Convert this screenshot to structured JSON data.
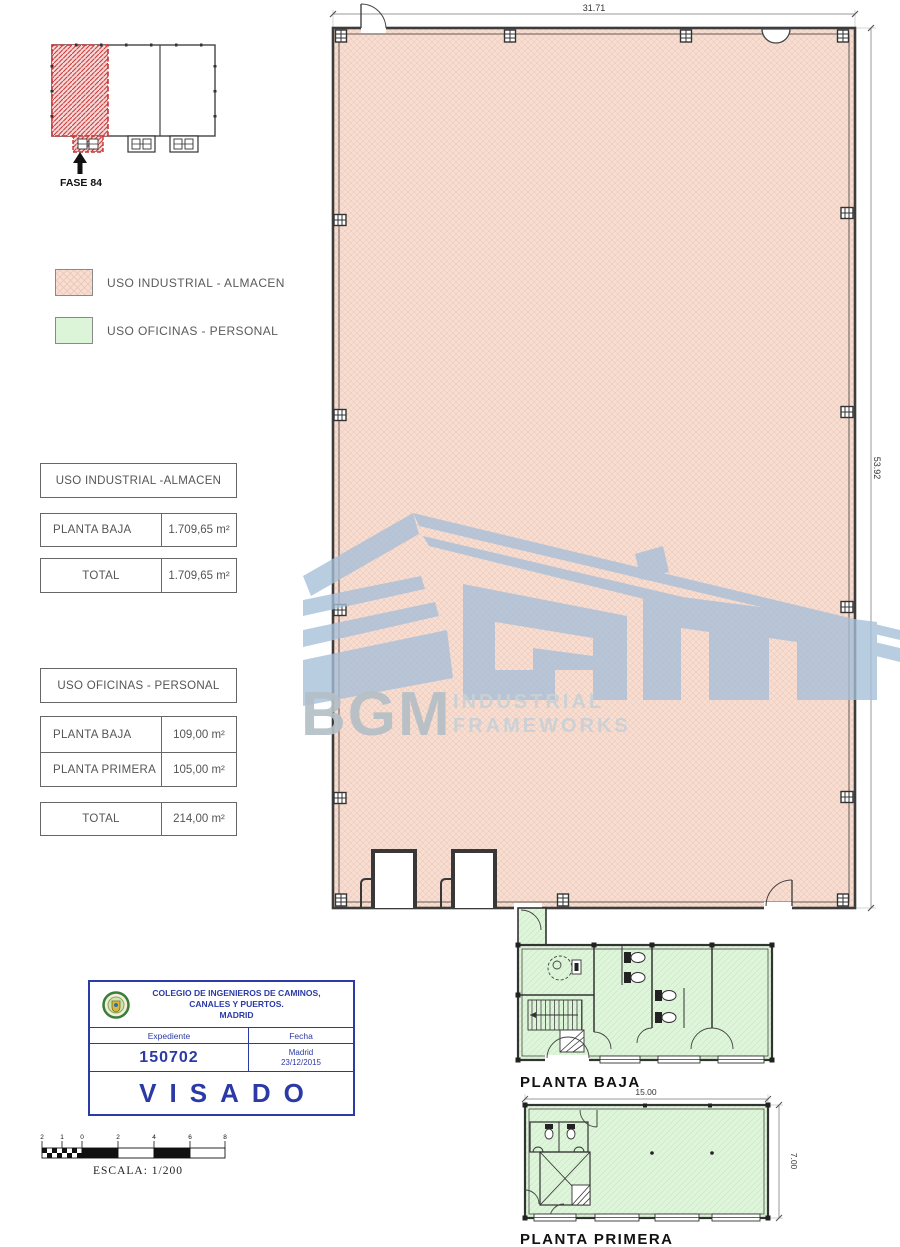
{
  "site": {
    "label": "FASE 84"
  },
  "legend": [
    {
      "label": "USO INDUSTRIAL - ALMACEN"
    },
    {
      "label": "USO OFICINAS - PERSONAL"
    }
  ],
  "tables": {
    "industrial": {
      "title": "USO INDUSTRIAL -ALMACEN",
      "row1_label": "PLANTA BAJA",
      "row1_value": "1.709,65 m²",
      "total_label": "TOTAL",
      "total_value": "1.709,65 m²"
    },
    "oficinas": {
      "title": "USO OFICINAS - PERSONAL",
      "row1_label": "PLANTA BAJA",
      "row1_value": "109,00 m²",
      "row2_label": "PLANTA PRIMERA",
      "row2_value": "105,00 m²",
      "total_label": "TOTAL",
      "total_value": "214,00 m²"
    }
  },
  "main_plan": {
    "width_dim": "31.71",
    "height_dim": "53.92"
  },
  "planta_baja": {
    "label": "PLANTA BAJA"
  },
  "planta_primera": {
    "label": "PLANTA PRIMERA",
    "width_dim": "15.00",
    "height_dim": "7.00"
  },
  "watermark": {
    "word": "BGM",
    "line1": "INDUSTRIAL",
    "line2": "FRAMEWORKS"
  },
  "stamp": {
    "org_line1": "COLEGIO DE INGENIEROS DE CAMINOS,",
    "org_line2": "CANALES Y PUERTOS.",
    "org_line3": "MADRID",
    "expediente_label": "Expediente",
    "fecha_label": "Fecha",
    "expediente_value": "150702",
    "fecha_city": "Madrid",
    "fecha_date": "23/12/2015",
    "visado": "VISADO"
  },
  "scalebar": {
    "label": "ESCALA:  1/200",
    "ticks": [
      "2",
      "1",
      "0",
      "2",
      "4",
      "6",
      "8"
    ]
  },
  "colors": {
    "industrial_fill": "#f8ded2",
    "oficinas_fill": "#dcf4d7",
    "stamp_blue": "#2b3aa6",
    "fase_red": "#c63636",
    "watermark_blue": "#a6bfd9"
  }
}
